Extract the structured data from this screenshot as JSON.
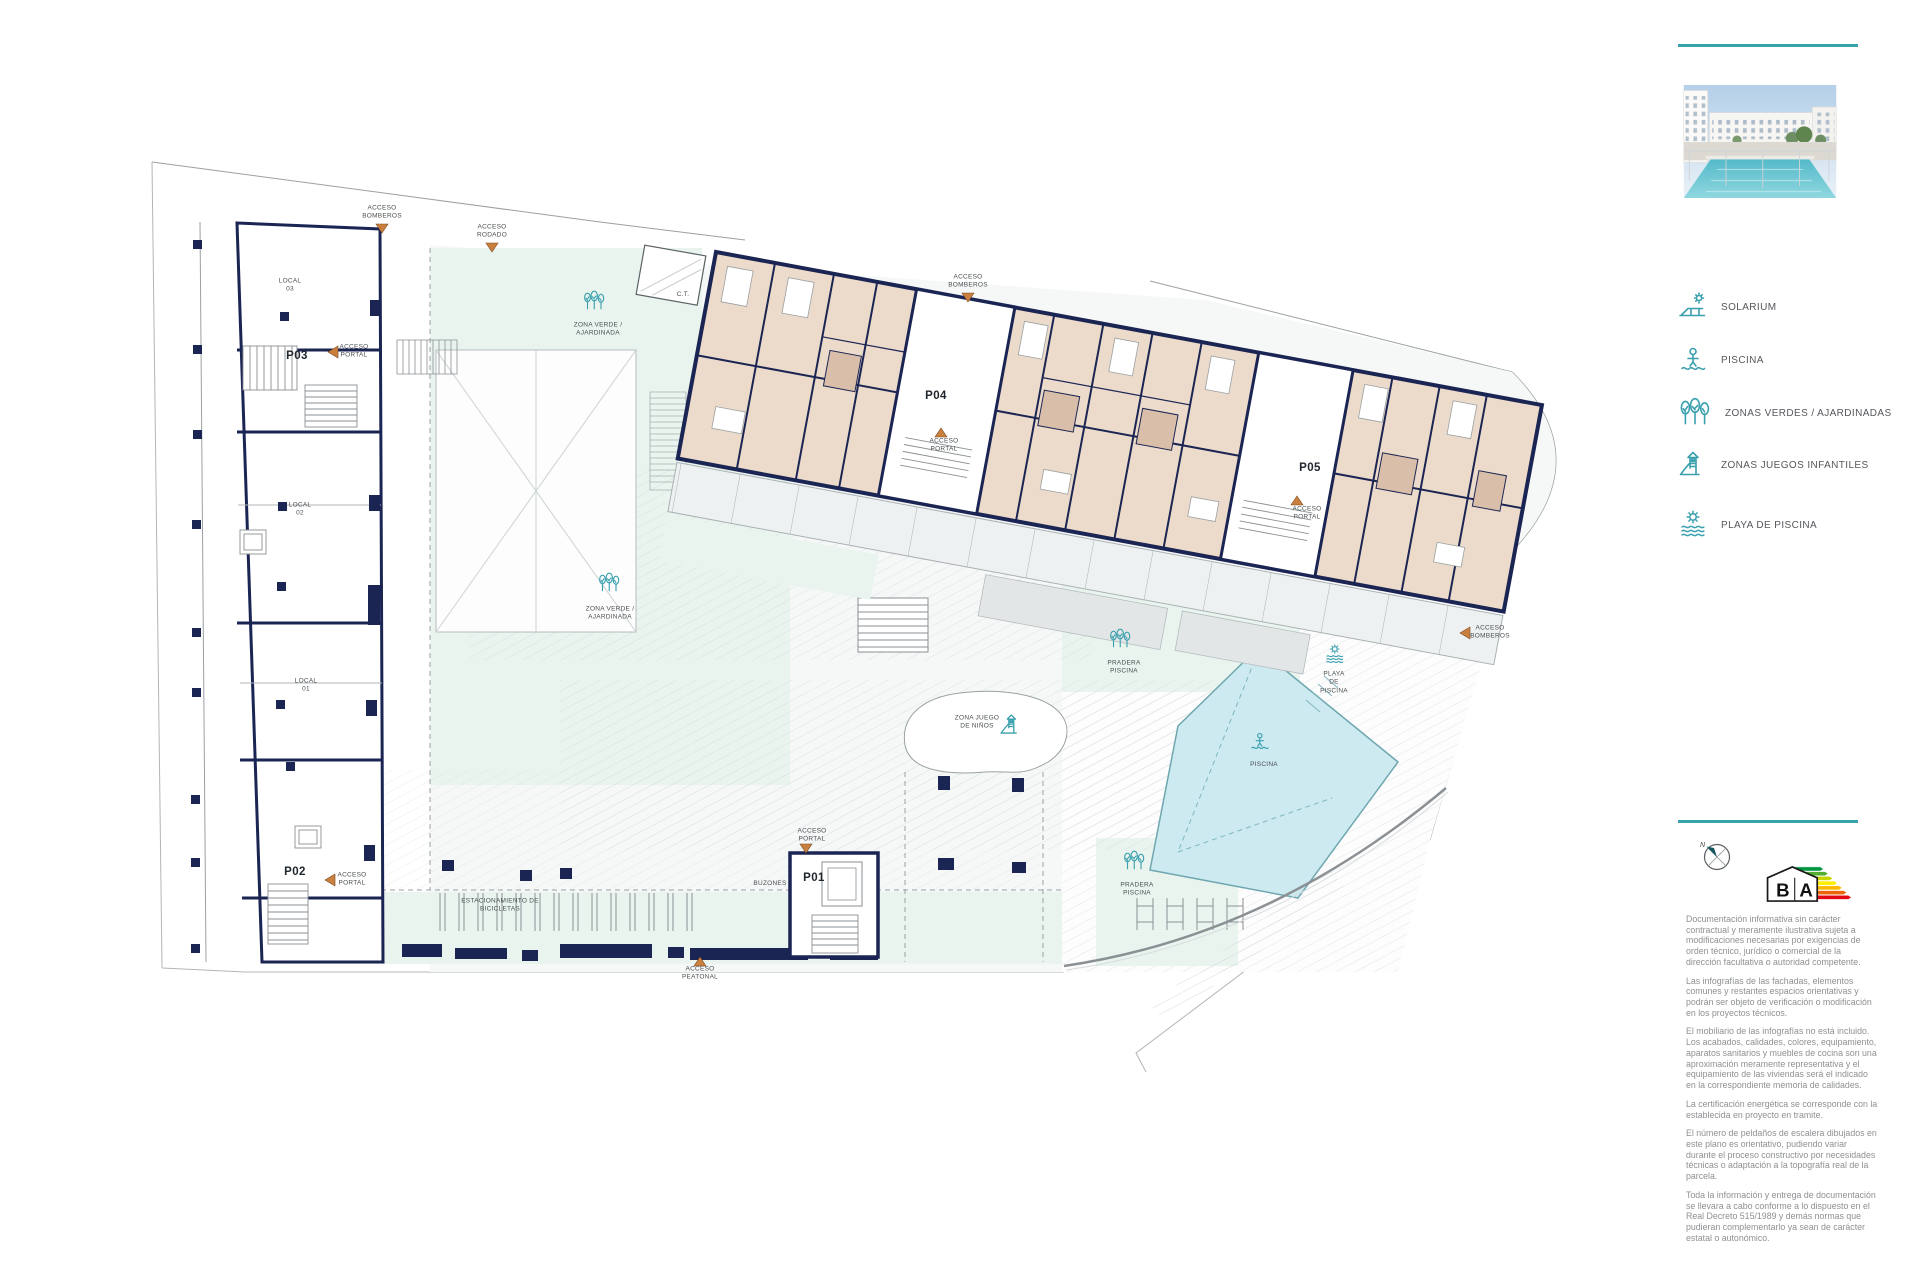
{
  "page": {
    "background": "#ffffff",
    "accent_color": "#35a2ae"
  },
  "plan": {
    "colors": {
      "wall_navy": "#1b2553",
      "room_beige": "#ecdbca",
      "bath_beige": "#d9bfa9",
      "green_zone": "#e9f4ef",
      "plaza": "#f6f8f8",
      "pool_cyan": "#cdeaf0",
      "icon_teal": "#3aa0ae",
      "access_marker_orange": "#c9803f"
    },
    "portals": {
      "p01": "P01",
      "p02": "P02",
      "p03": "P03",
      "p04": "P04",
      "p05": "P05"
    },
    "locals": {
      "l03": "LOCAL\n03",
      "l02": "LOCAL\n02",
      "l01": "LOCAL\n01"
    },
    "annotations": {
      "acceso_bomberos": "ACCESO\nBOMBEROS",
      "acceso_rodado": "ACCESO\nRODADO",
      "acceso_portal": "ACCESO\nPORTAL",
      "acceso_peatonal": "ACCESO\nPEATONAL",
      "ct": "C.T.",
      "zona_verde": "ZONA VERDE /\nAJARDINADA",
      "zona_juego": "ZONA JUEGO\nDE NIÑOS",
      "pradera": "PRADERA\nPISCINA",
      "playa": "PLAYA\nDE\nPISCINA",
      "piscina": "PISCINA",
      "buzones": "BUZONES",
      "bicicletas": "ESTACIONAMIENTO DE\nBICICLETAS"
    }
  },
  "sidebar": {
    "legend": [
      {
        "icon": "solarium-icon",
        "label": "SOLARIUM"
      },
      {
        "icon": "swimmer-icon",
        "label": "PISCINA"
      },
      {
        "icon": "trees-icon",
        "label": "ZONAS VERDES / AJARDINADAS"
      },
      {
        "icon": "slide-icon",
        "label": "ZONAS JUEGOS INFANTILES"
      },
      {
        "icon": "sun-waves-icon",
        "label": "PLAYA DE PISCINA"
      }
    ],
    "compass_north": "N",
    "energy_logo": {
      "letter_b": "B",
      "letter_a": "A",
      "colors": [
        "#009640",
        "#52ae32",
        "#c8d400",
        "#ffed00",
        "#fbba00",
        "#ec6608",
        "#e30613"
      ]
    },
    "disclaimer": [
      "Documentación informativa sin carácter contractual y meramente ilustrativa sujeta a modificaciones necesarias por exigencias de orden técnico, jurídico o comercial de la dirección facultativa o autoridad competente.",
      "Las infografías de las fachadas, elementos comunes y restantes espacios orientativas y podrán ser objeto de verificación o modificación en los proyectos técnicos.",
      "El mobiliario de las infografías no está incluido. Los acabados, calidades, colores, equipamiento, aparatos sanitarios y muebles de cocina son una aproximación meramente representativa y el equipamiento de las viviendas será el indicado en la correspondiente memoria de calidades.",
      "La certificación energética se corresponde con la establecida en proyecto en tramite.",
      "El número de peldaños de escalera dibujados en este plano es orientativo, pudiendo variar durante el proceso constructivo por necesidades técnicas o adaptación a la topografía real de la parcela.",
      "Toda la información y entrega de documentación se llevara a cabo conforme a lo dispuesto en el Real Decreto 515/1989 y demás normas que pudieran complementarlo ya sean de carácter estatal o autonómico."
    ]
  }
}
